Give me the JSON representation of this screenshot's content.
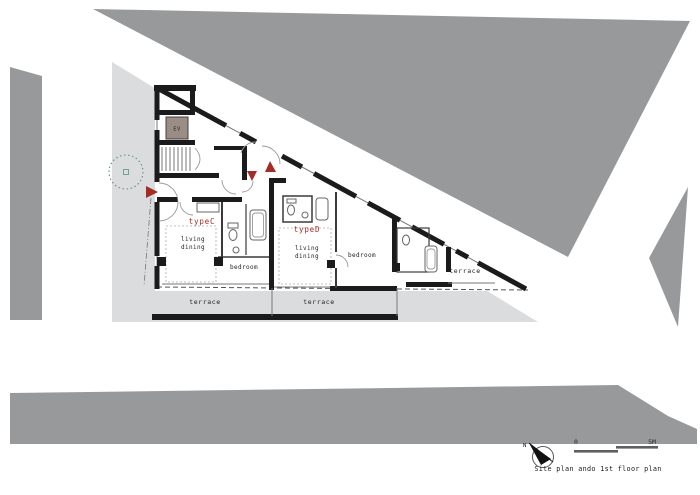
{
  "colors": {
    "context_gray": "#97999b",
    "site_gray": "#dbdcdd",
    "wall_black": "#1b1b1b",
    "accent_red": "#a42c26",
    "elevator_fill": "#9a8d85",
    "tree_green": "#5d8f84"
  },
  "plan": {
    "core": {
      "elevator_label": "EV"
    },
    "units": [
      {
        "name_label": "typeC",
        "living_label_line1": "living",
        "living_label_line2": "dining",
        "bedroom_label": "bedroom",
        "terrace_label": "terrace"
      },
      {
        "name_label": "typeD",
        "living_label_line1": "living",
        "living_label_line2": "dining",
        "bedroom_label": "bedroom",
        "terrace_label": "terrace"
      }
    ],
    "east_terrace_label": "terrace"
  },
  "legend": {
    "north_label": "N",
    "scale_start": "0",
    "scale_end": "5M",
    "caption": "Site plan ando 1st floor plan"
  }
}
